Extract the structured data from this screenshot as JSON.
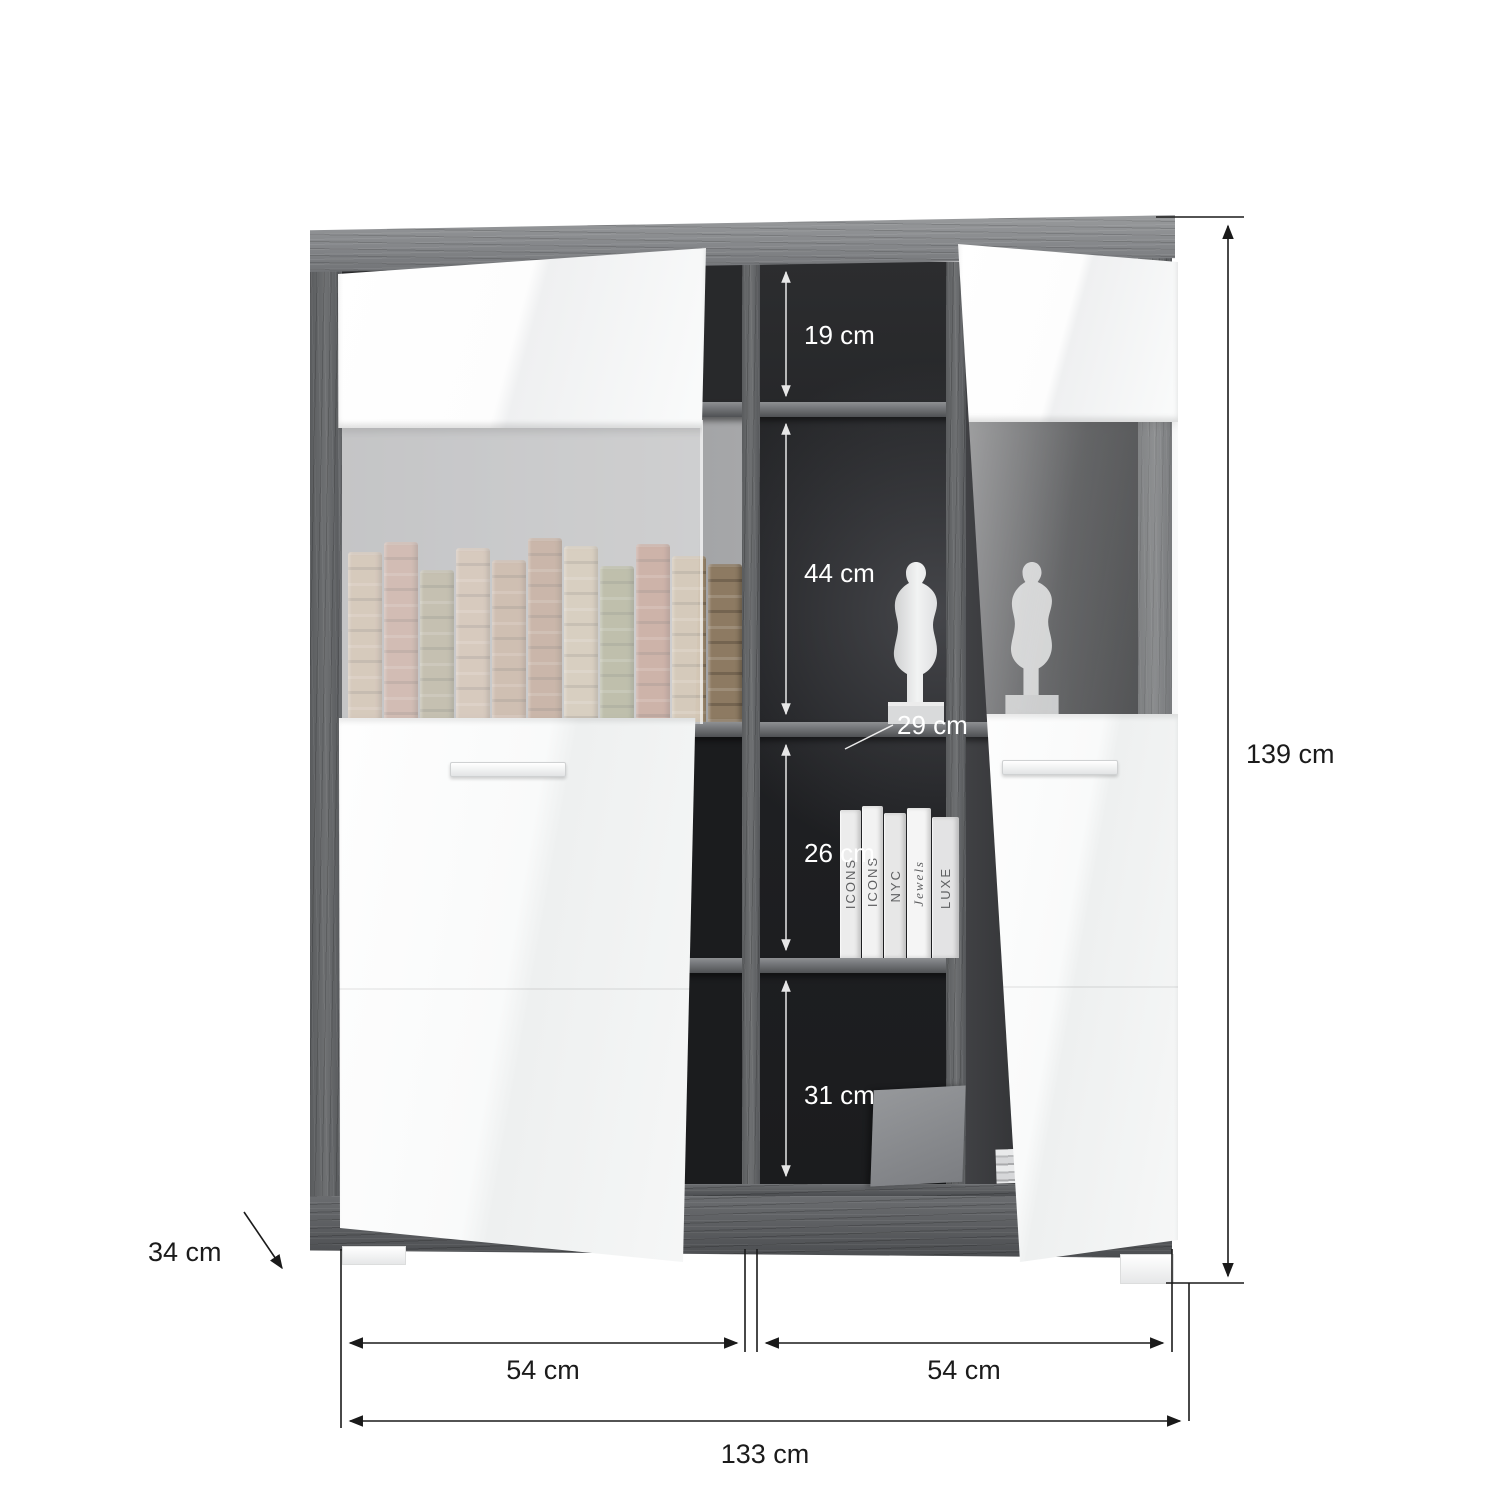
{
  "scene": {
    "kind": "furniture-dimension-diagram",
    "subject": "two-door display cabinet with open glass doors, centre shelves, statue and book decor"
  },
  "dims": {
    "inner": [
      {
        "name": "top-compartment-height",
        "label": "19 cm"
      },
      {
        "name": "display-compartment-height",
        "label": "44 cm"
      },
      {
        "name": "shelf-depth",
        "label": "29 cm"
      },
      {
        "name": "shelf-compartment-height",
        "label": "26 cm"
      },
      {
        "name": "bottom-compartment-height",
        "label": "31 cm"
      }
    ],
    "outer": [
      {
        "name": "total-height",
        "label": "139 cm"
      },
      {
        "name": "depth",
        "label": "34 cm"
      },
      {
        "name": "left-door-width",
        "label": "54 cm"
      },
      {
        "name": "right-door-width",
        "label": "54 cm"
      },
      {
        "name": "total-width",
        "label": "133 cm"
      }
    ]
  },
  "decor": {
    "book_titles": [
      "ICONS",
      "ICONS",
      "NYC",
      "Jewels",
      "LUXE"
    ],
    "statue_count": 2
  },
  "colors": {
    "background": "#ffffff",
    "wood_light": "#8b8d90",
    "wood_dark": "#5a5c5f",
    "interior_dark": "#232527",
    "interior_light_back": "#9b9c9e",
    "door_white": "#fafbfb",
    "dimension_text_dark": "#1b1b1b",
    "dimension_text_light": "#ffffff",
    "vintage_book_tones": [
      "#b3997f",
      "#a97f6e",
      "#8f8668",
      "#b59a83",
      "#a5846a",
      "#997259",
      "#b7a488",
      "#84855f",
      "#a06b58",
      "#b09a7b",
      "#8d7a62"
    ]
  }
}
